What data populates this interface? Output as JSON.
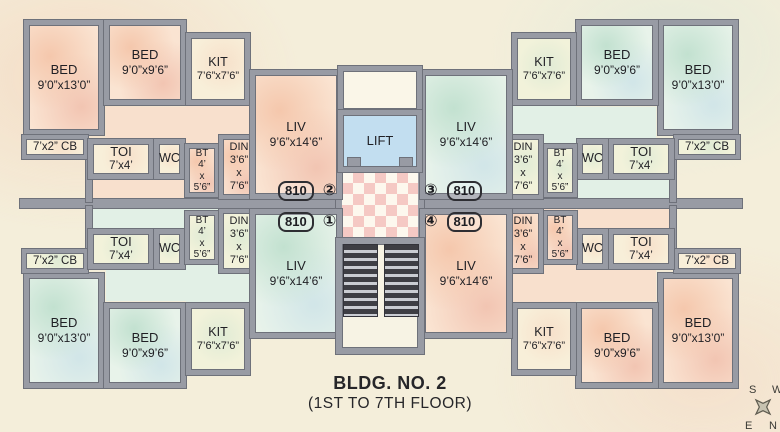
{
  "plan": {
    "title": "BLDG. NO. 2",
    "subtitle": "(1ST TO 7TH FLOOR)",
    "lift_label": "LIFT",
    "flats": [
      {
        "badge": "①",
        "area_label": "810"
      },
      {
        "badge": "②",
        "area_label": "810"
      },
      {
        "badge": "③",
        "area_label": "810"
      },
      {
        "badge": "④",
        "area_label": "810"
      }
    ],
    "room_types": {
      "bed_large": {
        "name": "BED",
        "dims": "9’0”x13’0”"
      },
      "bed_small": {
        "name": "BED",
        "dims": "9’0”x9’6”"
      },
      "kitchen": {
        "name": "KIT",
        "dims": "7’6”x7’6”"
      },
      "living": {
        "name": "LIV",
        "dims": "9’6”x14’6”"
      },
      "toilet": {
        "name": "TOI",
        "dims": "7’x4’"
      },
      "wc": {
        "name": "WC"
      },
      "bath": {
        "name": "BT",
        "dims": "4’\nx\n5’6”"
      },
      "dining": {
        "name": "DIN",
        "dims": "3’6”\nx\n7’6”"
      },
      "cupboard": {
        "name": "7’x2” CB"
      }
    },
    "compass": {
      "n": "N",
      "s": "S",
      "e": "E",
      "w": "W"
    },
    "colors": {
      "flat_pink": "#fae4d2",
      "flat_teal": "#e8f3ea",
      "cream_room": "#f8efd9",
      "lift_blue": "#c2def0",
      "wall_gray": "#989ba4",
      "checker_pink": "#f5c9c4",
      "stair_tread": "#3e3e44",
      "paper_cream": "#f4eeda"
    }
  }
}
